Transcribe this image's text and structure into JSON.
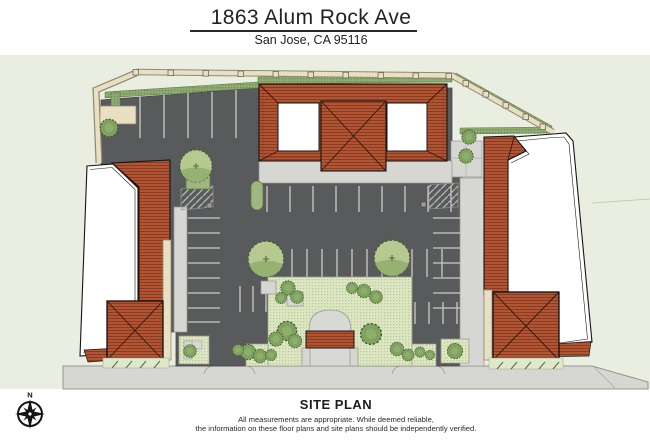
{
  "header": {
    "title": "1863 Alum Rock Ave",
    "subtitle": "San Jose, CA 95116"
  },
  "plan": {
    "label": "SITE PLAN",
    "disclaimer_line1": "All measurements are appropriate. While deemed reliable,",
    "disclaimer_line2": "the information on these floor plans and site plans should be independently verified."
  },
  "compass": {
    "north_label": "N"
  },
  "colors": {
    "site_ground": "#e9eee0",
    "asphalt": "#595a5c",
    "sidewalk": "#d6d6d2",
    "tile_roof": "#b15433",
    "flat_roof": "#ffffff",
    "landscape_green": "#8fae6d",
    "courtyard_ground": "#dce6c2",
    "hedge": "#8fab70",
    "perimeter_wall": "#e9e0c4",
    "text": "#1c1c1c"
  },
  "drawing_elements": [
    "north-building",
    "west-building",
    "east-building",
    "southwest-pavilion",
    "southeast-pavilion",
    "central-courtyard",
    "entry-trellis",
    "parking-lot",
    "parking-stripes",
    "perimeter-wall",
    "perimeter-hedge",
    "street-sidewalk",
    "driveways",
    "trees",
    "compass-rose"
  ]
}
